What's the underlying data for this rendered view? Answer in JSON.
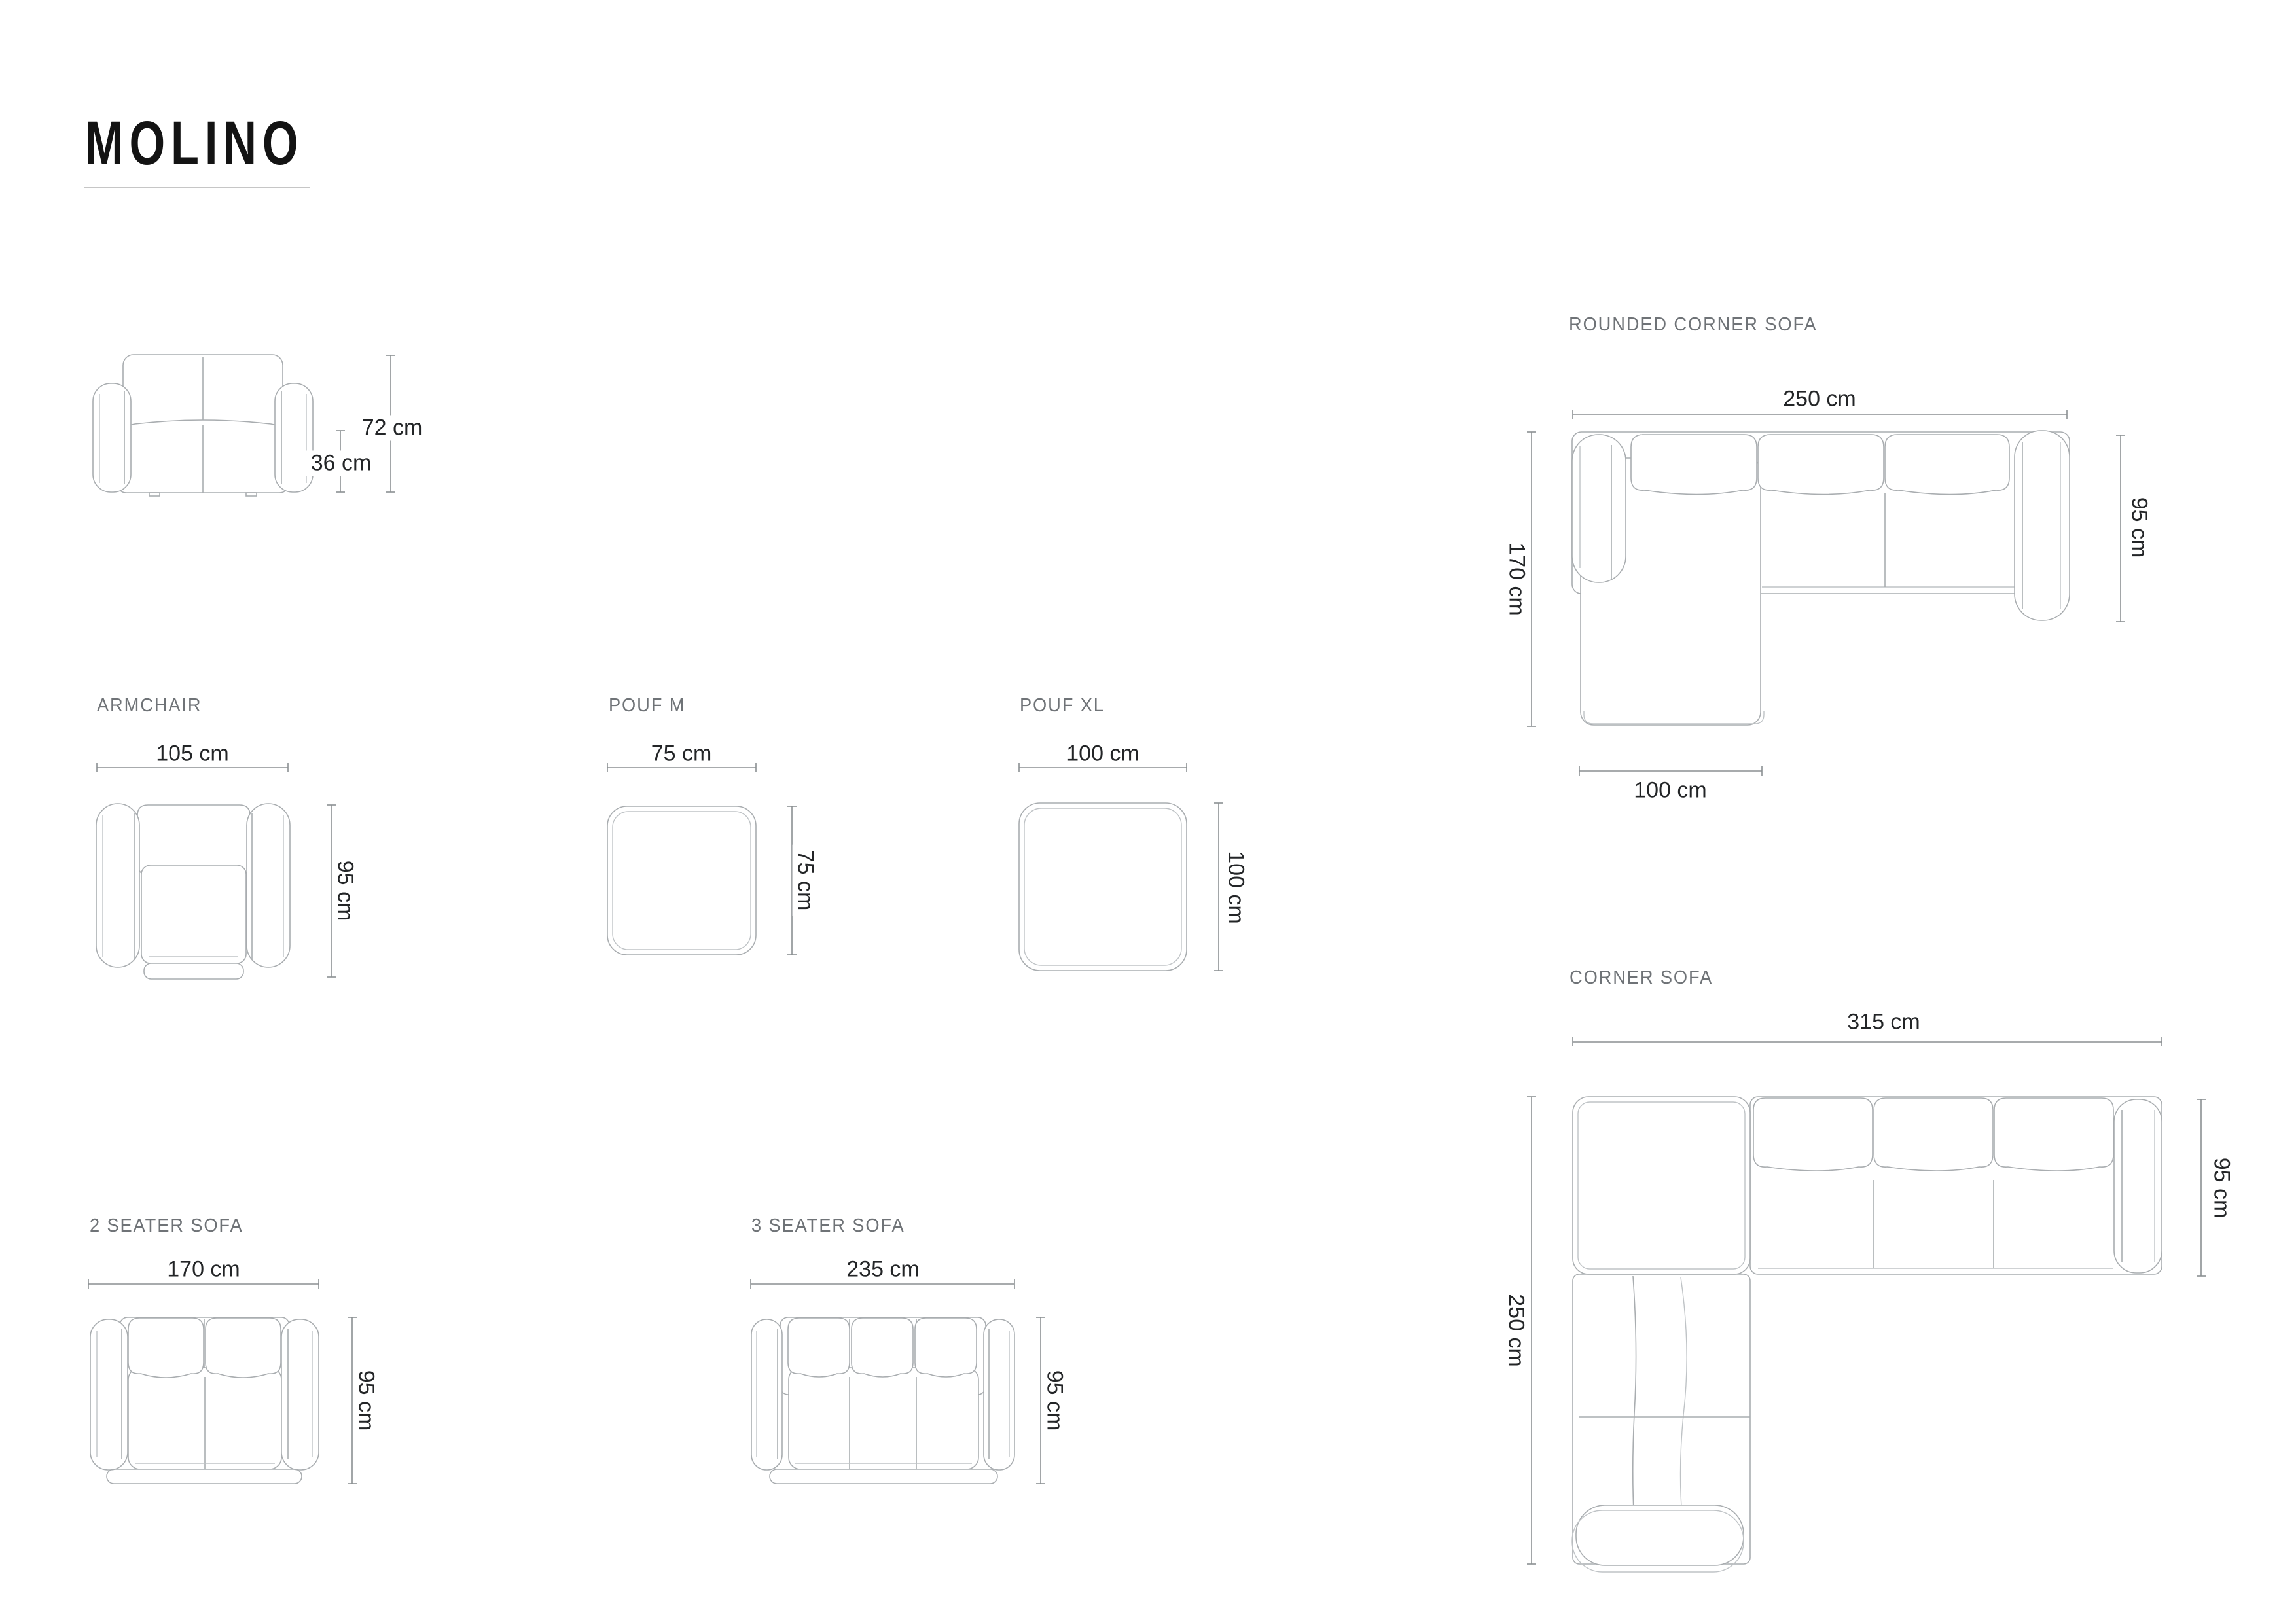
{
  "title": "MOLINO",
  "colors": {
    "title_text": "#131313",
    "underline": "#c6c6c6",
    "label_text": "#6f7377",
    "dimension_text": "#232527",
    "dimension_line": "#8b8f92",
    "furniture_line": "#a9adb0",
    "furniture_line_light": "#bfc3c6"
  },
  "products": {
    "sofa_front_view": {
      "height_label": "72 cm",
      "seat_height_label": "36 cm"
    },
    "armchair": {
      "label": "ARMCHAIR",
      "width_label": "105 cm",
      "depth_label": "95 cm"
    },
    "pouf_m": {
      "label": "POUF M",
      "width_label": "75 cm",
      "depth_label": "75 cm"
    },
    "pouf_xl": {
      "label": "POUF XL",
      "width_label": "100 cm",
      "depth_label": "100 cm"
    },
    "rounded_corner_sofa": {
      "label": "ROUNDED CORNER SOFA",
      "width_label": "250 cm",
      "depth_label": "95 cm",
      "side_length_label": "170 cm",
      "chaise_width_label": "100 cm"
    },
    "corner_sofa": {
      "label": "CORNER SOFA",
      "width_label": "315 cm",
      "depth_label": "95 cm",
      "side_length_label": "250 cm"
    },
    "two_seater_sofa": {
      "label": "2 SEATER SOFA",
      "width_label": "170 cm",
      "depth_label": "95 cm"
    },
    "three_seater_sofa": {
      "label": "3 SEATER SOFA",
      "width_label": "235 cm",
      "depth_label": "95 cm"
    }
  }
}
